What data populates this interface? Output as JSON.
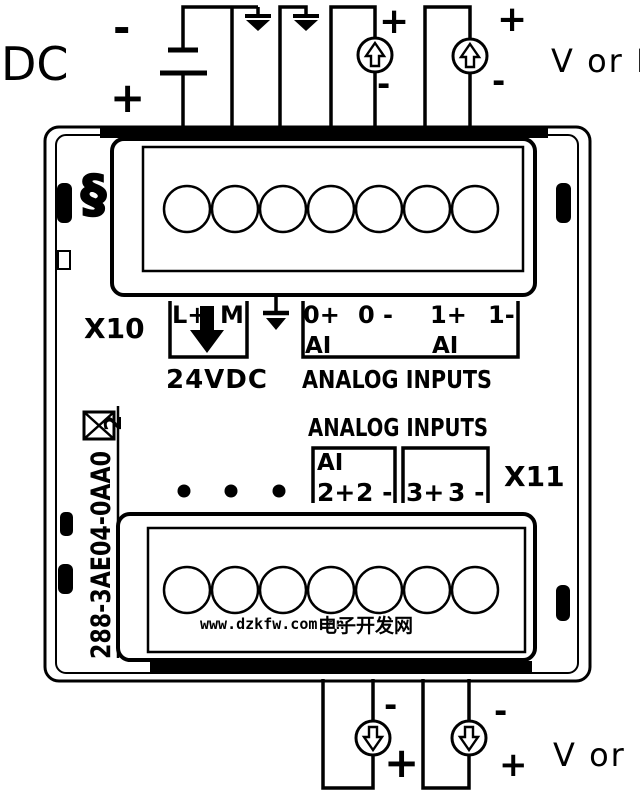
{
  "colors": {
    "line": "#000000",
    "background": "#ffffff",
    "watermark_url": "#2533cc",
    "watermark_site": "#4a5cd8"
  },
  "external": {
    "dc_label": "DC",
    "battery": {
      "minus": "-",
      "plus": "+"
    },
    "top_right_label": "V or I",
    "bottom_right_label": "V or I",
    "source_0": {
      "plus": "+",
      "minus": "-"
    },
    "source_1": {
      "plus": "+",
      "minus": "-"
    },
    "source_2": {
      "minus": "-",
      "plus": "+"
    },
    "source_3": {
      "minus": "-",
      "plus": "+"
    }
  },
  "module": {
    "clip_icon": "§",
    "x10_label": "X10",
    "x11_label": "X11",
    "part_number": "288-3AE04-0AA0",
    "port_marker": "2",
    "power": {
      "l_plus": "L+",
      "m": "M",
      "caption": "24VDC"
    },
    "x10_terminals": {
      "t0_plus": "0+",
      "t0_minus": "0 -",
      "t1_plus": "1+",
      "t1_minus": "1-",
      "ai_0": "AI",
      "ai_1": "AI",
      "caption": "ANALOG INPUTS"
    },
    "x11_terminals": {
      "heading": "ANALOG INPUTS",
      "ai": "AI",
      "t2_plus": "2+",
      "t2_minus": "2 -",
      "t3_plus": "3+",
      "t3_minus": "3 -"
    }
  },
  "watermark": {
    "url": "www.dzkfw.com.cn",
    "site": "电子开发网"
  }
}
